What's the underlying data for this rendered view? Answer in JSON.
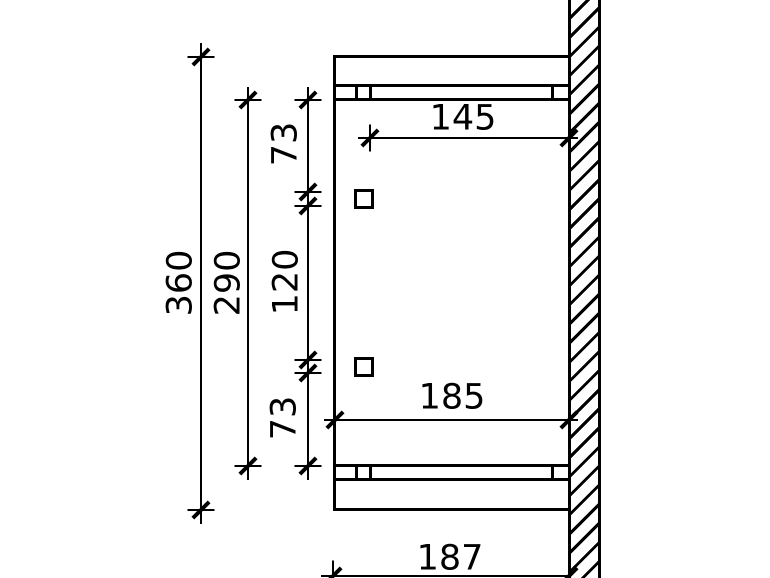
{
  "drawing": {
    "title": "canopy-side-elevation",
    "dimensions": {
      "total_height": "360",
      "rail_span": "290",
      "upper_spacing": "73",
      "middle_spacing": "120",
      "lower_spacing": "73",
      "bracket_depth": "145",
      "rail_depth": "185",
      "total_depth": "187"
    },
    "colors": {
      "line": "#000000",
      "background": "#ffffff"
    }
  }
}
